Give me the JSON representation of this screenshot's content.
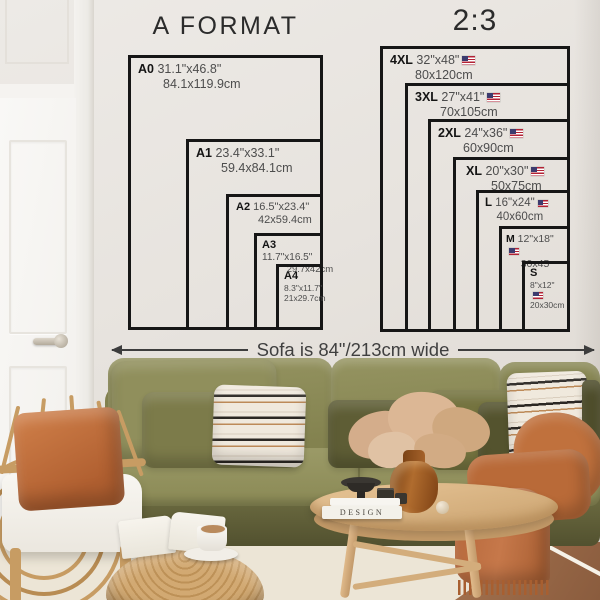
{
  "charts": {
    "a_format": {
      "title": "A FORMAT",
      "sizes": [
        {
          "label": "A0",
          "inches": "31.1\"x46.8\"",
          "cm": "84.1x119.9cm"
        },
        {
          "label": "A1",
          "inches": "23.4\"x33.1\"",
          "cm": "59.4x84.1cm"
        },
        {
          "label": "A2",
          "inches": "16.5\"x23.4\"",
          "cm": "42x59.4cm"
        },
        {
          "label": "A3",
          "inches": "11.7\"x16.5\"",
          "cm": "29.7x42cm"
        },
        {
          "label": "A4",
          "inches": "8.3\"x11.7\"",
          "cm": "21x29.7cm"
        }
      ]
    },
    "ratio_2_3": {
      "title": "2:3",
      "sizes": [
        {
          "label": "4XL",
          "inches": "32\"x48\"",
          "cm": "80x120cm",
          "flag_icon": "us-flag-icon"
        },
        {
          "label": "3XL",
          "inches": "27\"x41\"",
          "cm": "70x105cm",
          "flag_icon": "us-flag-icon"
        },
        {
          "label": "2XL",
          "inches": "24\"x36\"",
          "cm": "60x90cm",
          "flag_icon": "us-flag-icon"
        },
        {
          "label": "XL",
          "inches": "20\"x30\"",
          "cm": "50x75cm",
          "flag_icon": "us-flag-icon"
        },
        {
          "label": "L",
          "inches": "16\"x24\"",
          "cm": "40x60cm",
          "flag_icon": "us-flag-icon"
        },
        {
          "label": "M",
          "inches": "12\"x18\"",
          "cm": "30x45",
          "flag_icon": "us-flag-icon"
        },
        {
          "label": "S",
          "inches": "8\"x12\"",
          "cm": "20x30cm",
          "flag_icon": "us-flag-icon"
        }
      ]
    }
  },
  "sofa_note": {
    "text": "Sofa is 84\"/213cm wide"
  },
  "scene": {
    "design_book_spine": "DESIGN"
  },
  "colors": {
    "chart_line": "#161616",
    "wall": "#e8e4df",
    "sofa_olive": "#8c8b59",
    "pillow_dark_olive": "#5e5d35",
    "rust": "#b96a38",
    "rattan": "#c79c63",
    "table_wood": "#d9b588",
    "rug": "#ece5d6",
    "floor_wood": "#9a6a4a",
    "flag_red": "#b22234",
    "flag_blue": "#3c3b6e"
  }
}
